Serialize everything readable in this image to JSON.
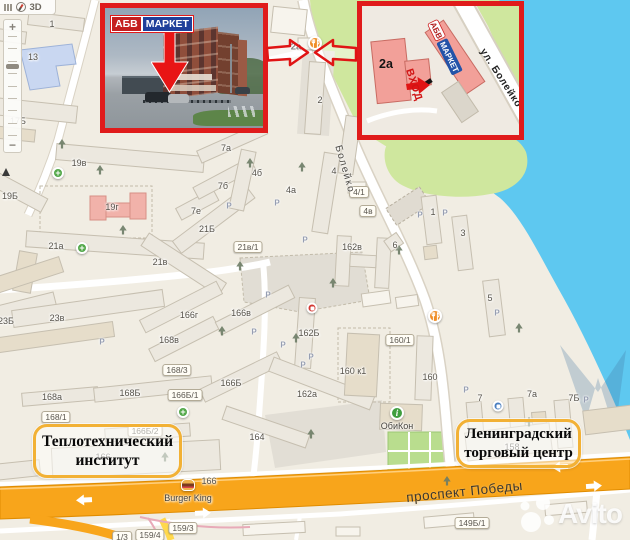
{
  "toolbar": {
    "button_3d": "3D"
  },
  "zoom_control": {
    "plus": "+",
    "minus": "−"
  },
  "photo_inset": {
    "sign": {
      "abv": "АБВ",
      "market": "МАРКЕТ"
    }
  },
  "map_inset": {
    "building_label": "2а",
    "sign": {
      "abv": "АБВ",
      "market": "МАРКЕТ"
    },
    "entrance_label": "ВХОД",
    "street_label": "ул. Болейко"
  },
  "callouts": {
    "left": {
      "line1": "Теплотехнический",
      "line2": "институт"
    },
    "right": {
      "line1": "Ленинградский",
      "line2": "торговый центр"
    }
  },
  "streets": {
    "prospekt": "проспект Победы",
    "boleyko": "Болейко"
  },
  "watermark": {
    "text": "Avito"
  },
  "colors": {
    "accent_red": "#e01b1b",
    "highway": "#f8a51b",
    "water": "#5ec8f0",
    "green": "#cfe79e",
    "callout_border": "#f2b135",
    "sign_blue": "#2353a8",
    "sign_red": "#c41f1f"
  },
  "map": {
    "parking_glyph": "Р",
    "labels": [
      {
        "t": "1",
        "x": 52,
        "y": 24
      },
      {
        "t": "13",
        "x": 33,
        "y": 57
      },
      {
        "t": "17Б",
        "x": 18,
        "y": 121
      },
      {
        "t": "19в",
        "x": 79,
        "y": 163
      },
      {
        "t": "19Б",
        "x": 10,
        "y": 196
      },
      {
        "t": "19г",
        "x": 112,
        "y": 207
      },
      {
        "t": "21а",
        "x": 56,
        "y": 246
      },
      {
        "t": "21в",
        "x": 160,
        "y": 262
      },
      {
        "t": "7е",
        "x": 196,
        "y": 211
      },
      {
        "t": "21Б",
        "x": 207,
        "y": 229
      },
      {
        "t": "21в/1",
        "x": 248,
        "y": 247,
        "pill": true
      },
      {
        "t": "7а",
        "x": 226,
        "y": 148
      },
      {
        "t": "7б",
        "x": 223,
        "y": 186
      },
      {
        "t": "4б",
        "x": 257,
        "y": 173
      },
      {
        "t": "4а",
        "x": 291,
        "y": 190
      },
      {
        "t": "4",
        "x": 334,
        "y": 171
      },
      {
        "t": "4/1",
        "x": 359,
        "y": 192,
        "pill": true
      },
      {
        "t": "4в",
        "x": 368,
        "y": 211,
        "pill": true
      },
      {
        "t": "2а",
        "x": 296,
        "y": 47,
        "bold": true
      },
      {
        "t": "2",
        "x": 320,
        "y": 100
      },
      {
        "t": "162в",
        "x": 352,
        "y": 247
      },
      {
        "t": "6",
        "x": 395,
        "y": 245
      },
      {
        "t": "1",
        "x": 433,
        "y": 212
      },
      {
        "t": "3",
        "x": 463,
        "y": 233
      },
      {
        "t": "5",
        "x": 490,
        "y": 298
      },
      {
        "t": "23Б",
        "x": 6,
        "y": 321
      },
      {
        "t": "23в",
        "x": 57,
        "y": 318
      },
      {
        "t": "166г",
        "x": 189,
        "y": 315
      },
      {
        "t": "166в",
        "x": 241,
        "y": 313
      },
      {
        "t": "168в",
        "x": 169,
        "y": 340
      },
      {
        "t": "168/3",
        "x": 177,
        "y": 370,
        "pill": true
      },
      {
        "t": "168а",
        "x": 52,
        "y": 397
      },
      {
        "t": "168Б",
        "x": 130,
        "y": 393
      },
      {
        "t": "166Б/1",
        "x": 185,
        "y": 395,
        "pill": true
      },
      {
        "t": "168/1",
        "x": 56,
        "y": 417,
        "pill": true
      },
      {
        "t": "162Б",
        "x": 309,
        "y": 333
      },
      {
        "t": "160/1",
        "x": 400,
        "y": 340,
        "pill": true
      },
      {
        "t": "160 к1",
        "x": 353,
        "y": 371
      },
      {
        "t": "166Б",
        "x": 231,
        "y": 383
      },
      {
        "t": "162а",
        "x": 307,
        "y": 394
      },
      {
        "t": "164",
        "x": 257,
        "y": 437
      },
      {
        "t": "160",
        "x": 430,
        "y": 377
      },
      {
        "t": "7",
        "x": 480,
        "y": 398
      },
      {
        "t": "7а",
        "x": 532,
        "y": 394
      },
      {
        "t": "7Б",
        "x": 574,
        "y": 398
      },
      {
        "t": "166Б/2",
        "x": 145,
        "y": 431,
        "pill": true
      },
      {
        "t": "166",
        "x": 103,
        "y": 457
      },
      {
        "t": "166",
        "x": 209,
        "y": 481
      },
      {
        "t": "158",
        "x": 512,
        "y": 447
      },
      {
        "t": "159/3",
        "x": 183,
        "y": 528,
        "pill": true
      },
      {
        "t": "159/4",
        "x": 150,
        "y": 535,
        "pill": true
      },
      {
        "t": "1/3",
        "x": 122,
        "y": 537,
        "pill": true
      },
      {
        "t": "149Б/1",
        "x": 472,
        "y": 523,
        "pill": true
      }
    ],
    "parking": [
      [
        229,
        206
      ],
      [
        277,
        203
      ],
      [
        305,
        240
      ],
      [
        268,
        295
      ],
      [
        283,
        345
      ],
      [
        303,
        365
      ],
      [
        420,
        215
      ],
      [
        445,
        213
      ],
      [
        466,
        390
      ],
      [
        497,
        313
      ],
      [
        586,
        400
      ],
      [
        311,
        357
      ],
      [
        254,
        332
      ],
      [
        102,
        342
      ]
    ],
    "trees": [
      [
        100,
        170
      ],
      [
        240,
        266
      ],
      [
        250,
        163
      ],
      [
        302,
        167
      ],
      [
        123,
        230
      ],
      [
        296,
        338
      ],
      [
        222,
        331
      ],
      [
        399,
        250
      ],
      [
        311,
        434
      ],
      [
        519,
        328
      ],
      [
        165,
        457
      ],
      [
        529,
        422
      ],
      [
        447,
        481
      ],
      [
        62,
        144
      ],
      [
        333,
        283
      ]
    ],
    "pois": [
      {
        "type": "restaurant",
        "x": 315,
        "y": 43
      },
      {
        "type": "restaurant",
        "x": 435,
        "y": 316
      },
      {
        "type": "info",
        "x": 397,
        "y": 413,
        "label": "ОбиКон"
      },
      {
        "type": "burger",
        "x": 188,
        "y": 485,
        "label": "Burger King"
      },
      {
        "type": "pharm",
        "x": 58,
        "y": 173
      },
      {
        "type": "pharm",
        "x": 82,
        "y": 248
      },
      {
        "type": "pharm",
        "x": 183,
        "y": 412
      },
      {
        "type": "shop_red",
        "x": 312,
        "y": 308
      },
      {
        "type": "shop_blue",
        "x": 498,
        "y": 406
      },
      {
        "type": "monument",
        "x": 6,
        "y": 172
      }
    ]
  }
}
